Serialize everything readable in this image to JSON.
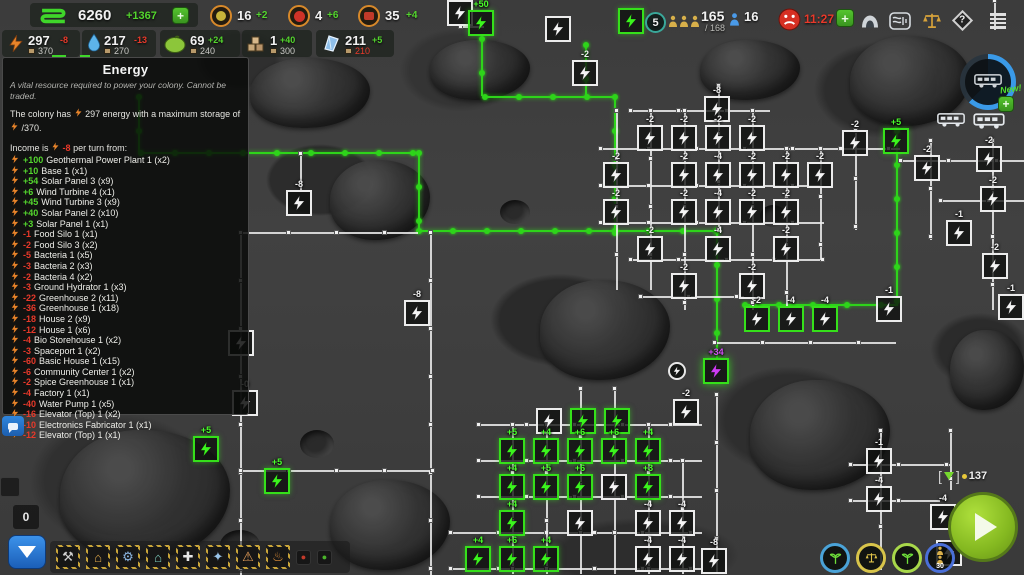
{
  "top_bar": {
    "credits": {
      "value": "6260",
      "delta": "+1367"
    },
    "plus_label": "+",
    "row1": [
      {
        "name": "spice",
        "value": "16",
        "delta": "+2"
      },
      {
        "name": "berries",
        "value": "4",
        "delta": "+6"
      },
      {
        "name": "tools",
        "value": "35",
        "delta": "+4"
      }
    ],
    "resources": [
      {
        "name": "energy",
        "value": "297",
        "delta": "-8",
        "negative": true,
        "cap": "370",
        "cap_red": false
      },
      {
        "name": "water",
        "value": "217",
        "delta": "-13",
        "negative": true,
        "cap": "270",
        "cap_red": false
      },
      {
        "name": "food",
        "value": "69",
        "delta": "+24",
        "negative": false,
        "cap": "240",
        "cap_red": false
      },
      {
        "name": "goods",
        "value": "1",
        "delta": "+40",
        "negative": false,
        "cap": "300",
        "cap_red": false
      },
      {
        "name": "minerals",
        "value": "211",
        "delta": "+5",
        "negative": false,
        "cap": "210",
        "cap_red": true
      }
    ]
  },
  "top_right": {
    "round": "5",
    "population": "165",
    "population_cap": "/ 168",
    "workers": "16",
    "unrest_timer": "11:27",
    "plus_label": "+"
  },
  "rover_panel": {
    "new_label": "New!",
    "plus_label": "+"
  },
  "tooltip": {
    "title": "Energy",
    "description": "A vital resource required to power your colony. Cannot be traded.",
    "line1_pre": "The colony has",
    "line1_mid": "297 energy with a maximum storage of",
    "line1_post": "/370.",
    "income_pre": "Income is",
    "income_value": "-8",
    "income_post": "per turn from:",
    "income_items": [
      {
        "value": "+100",
        "label": "Geothermal Power Plant 1  (x2)"
      },
      {
        "value": "+10",
        "label": "Base 1  (x1)"
      },
      {
        "value": "+54",
        "label": "Solar Panel 3  (x9)"
      },
      {
        "value": "+6",
        "label": "Wind Turbine 4  (x1)"
      },
      {
        "value": "+45",
        "label": "Wind Turbine 3  (x9)"
      },
      {
        "value": "+40",
        "label": "Solar Panel 2  (x10)"
      },
      {
        "value": "+3",
        "label": "Solar Panel 1  (x1)"
      },
      {
        "value": "-1",
        "label": "Food Silo 1  (x1)"
      },
      {
        "value": "-2",
        "label": "Food Silo 3  (x2)"
      },
      {
        "value": "-5",
        "label": "Bacteria 1  (x5)"
      },
      {
        "value": "-3",
        "label": "Bacteria 2  (x3)"
      },
      {
        "value": "-2",
        "label": "Bacteria 4  (x2)"
      },
      {
        "value": "-3",
        "label": "Ground Hydrator 1  (x3)"
      },
      {
        "value": "-22",
        "label": "Greenhouse 2  (x11)"
      },
      {
        "value": "-36",
        "label": "Greenhouse 1  (x18)"
      },
      {
        "value": "-18",
        "label": "House 2  (x9)"
      },
      {
        "value": "-12",
        "label": "House 1  (x6)"
      },
      {
        "value": "-4",
        "label": "Bio Storehouse 1  (x2)"
      },
      {
        "value": "-3",
        "label": "Spaceport 1  (x2)"
      },
      {
        "value": "-60",
        "label": "Basic House 1  (x15)"
      },
      {
        "value": "-6",
        "label": "Community Center 1  (x2)"
      },
      {
        "value": "-2",
        "label": "Spice Greenhouse 1  (x1)"
      },
      {
        "value": "-4",
        "label": "Factory 1  (x1)"
      },
      {
        "value": "-40",
        "label": "Water Pump 1  (x5)"
      },
      {
        "value": "-16",
        "label": "Elevator (Top) 1  (x2)"
      },
      {
        "value": "-10",
        "label": "Electronics Fabricator 1  (x1)"
      },
      {
        "value": "-12",
        "label": "Elevator (Top) 1  (x1)"
      }
    ]
  },
  "bottom": {
    "counter": "0"
  },
  "pod": {
    "value": "137"
  },
  "toolbar": {
    "items": [
      {
        "name": "mining",
        "glyph": "⚒",
        "color": "#cfcfcf",
        "small": false
      },
      {
        "name": "production",
        "glyph": "⌂",
        "color": "#e0a84a",
        "small": false
      },
      {
        "name": "engineering",
        "glyph": "⚙",
        "color": "#8ab4e0",
        "small": false
      },
      {
        "name": "housing",
        "glyph": "⌂",
        "color": "#7fd0c0",
        "small": false
      },
      {
        "name": "storage",
        "glyph": "✚",
        "color": "#e8e8e8",
        "small": false
      },
      {
        "name": "science",
        "glyph": "✦",
        "color": "#9ac4e8",
        "small": false
      },
      {
        "name": "alerts",
        "glyph": "⚠",
        "color": "#e8a05a",
        "small": false
      },
      {
        "name": "heat",
        "glyph": "♨",
        "color": "#e8943a",
        "small": false
      },
      {
        "name": "marker-red",
        "glyph": "●",
        "color": "#c23a2a",
        "small": true
      },
      {
        "name": "marker-green",
        "glyph": "●",
        "color": "#4ab42a",
        "small": true
      }
    ]
  },
  "map": {
    "nodes": [
      {
        "x": 447,
        "y": 0,
        "l": "",
        "t": "c"
      },
      {
        "x": 468,
        "y": 10,
        "l": "+50",
        "t": "p"
      },
      {
        "x": 545,
        "y": 16,
        "l": "",
        "t": "c"
      },
      {
        "x": 572,
        "y": 60,
        "l": "-2",
        "t": "c"
      },
      {
        "x": 618,
        "y": 8,
        "l": "",
        "t": "p"
      },
      {
        "x": 704,
        "y": 96,
        "l": "-8",
        "t": "c"
      },
      {
        "x": 637,
        "y": 125,
        "l": "-2",
        "t": "c"
      },
      {
        "x": 671,
        "y": 125,
        "l": "-2",
        "t": "c"
      },
      {
        "x": 705,
        "y": 125,
        "l": "-2",
        "t": "c"
      },
      {
        "x": 739,
        "y": 125,
        "l": "-2",
        "t": "c"
      },
      {
        "x": 603,
        "y": 162,
        "l": "-2",
        "t": "c"
      },
      {
        "x": 671,
        "y": 162,
        "l": "-2",
        "t": "c"
      },
      {
        "x": 705,
        "y": 162,
        "l": "-4",
        "t": "c"
      },
      {
        "x": 739,
        "y": 162,
        "l": "-2",
        "t": "c"
      },
      {
        "x": 773,
        "y": 162,
        "l": "-2",
        "t": "c"
      },
      {
        "x": 807,
        "y": 162,
        "l": "-2",
        "t": "c"
      },
      {
        "x": 603,
        "y": 199,
        "l": "-2",
        "t": "c"
      },
      {
        "x": 671,
        "y": 199,
        "l": "-2",
        "t": "c"
      },
      {
        "x": 705,
        "y": 199,
        "l": "-4",
        "t": "c"
      },
      {
        "x": 739,
        "y": 199,
        "l": "-2",
        "t": "c"
      },
      {
        "x": 773,
        "y": 199,
        "l": "-2",
        "t": "c"
      },
      {
        "x": 637,
        "y": 236,
        "l": "-2",
        "t": "c"
      },
      {
        "x": 705,
        "y": 236,
        "l": "-4",
        "t": "c"
      },
      {
        "x": 773,
        "y": 236,
        "l": "-2",
        "t": "c"
      },
      {
        "x": 671,
        "y": 273,
        "l": "-2",
        "t": "c"
      },
      {
        "x": 739,
        "y": 273,
        "l": "-2",
        "t": "c"
      },
      {
        "x": 842,
        "y": 130,
        "l": "-2",
        "t": "c"
      },
      {
        "x": 914,
        "y": 155,
        "l": "-2",
        "t": "c"
      },
      {
        "x": 976,
        "y": 146,
        "l": "-2",
        "t": "c"
      },
      {
        "x": 980,
        "y": 186,
        "l": "-2",
        "t": "c"
      },
      {
        "x": 946,
        "y": 220,
        "l": "-1",
        "t": "c"
      },
      {
        "x": 982,
        "y": 253,
        "l": "-2",
        "t": "c"
      },
      {
        "x": 998,
        "y": 294,
        "l": "-1",
        "t": "c"
      },
      {
        "x": 883,
        "y": 128,
        "l": "+5",
        "t": "p"
      },
      {
        "x": 744,
        "y": 306,
        "l": "-2",
        "t": "pw"
      },
      {
        "x": 778,
        "y": 306,
        "l": "-4",
        "t": "pw"
      },
      {
        "x": 812,
        "y": 306,
        "l": "-4",
        "t": "pw"
      },
      {
        "x": 876,
        "y": 296,
        "l": "-1",
        "t": "c"
      },
      {
        "x": 703,
        "y": 358,
        "l": "+34",
        "t": "s"
      },
      {
        "x": 673,
        "y": 399,
        "l": "-2",
        "t": "c"
      },
      {
        "x": 286,
        "y": 190,
        "l": "-8",
        "t": "c"
      },
      {
        "x": 404,
        "y": 300,
        "l": "-8",
        "t": "c"
      },
      {
        "x": 228,
        "y": 330,
        "l": "",
        "t": "c"
      },
      {
        "x": 232,
        "y": 390,
        "l": "-0",
        "t": "c"
      },
      {
        "x": 193,
        "y": 436,
        "l": "+5",
        "t": "p"
      },
      {
        "x": 264,
        "y": 468,
        "l": "+5",
        "t": "p"
      },
      {
        "x": 536,
        "y": 408,
        "l": "",
        "t": "c"
      },
      {
        "x": 570,
        "y": 408,
        "l": "",
        "t": "p"
      },
      {
        "x": 604,
        "y": 408,
        "l": "",
        "t": "p"
      },
      {
        "x": 499,
        "y": 438,
        "l": "+5",
        "t": "p"
      },
      {
        "x": 533,
        "y": 438,
        "l": "+4",
        "t": "p"
      },
      {
        "x": 567,
        "y": 438,
        "l": "+6",
        "t": "p"
      },
      {
        "x": 601,
        "y": 438,
        "l": "+6",
        "t": "p"
      },
      {
        "x": 635,
        "y": 438,
        "l": "+4",
        "t": "p"
      },
      {
        "x": 499,
        "y": 474,
        "l": "+4",
        "t": "p"
      },
      {
        "x": 533,
        "y": 474,
        "l": "+5",
        "t": "p"
      },
      {
        "x": 567,
        "y": 474,
        "l": "+6",
        "t": "p"
      },
      {
        "x": 601,
        "y": 474,
        "l": "",
        "t": "c"
      },
      {
        "x": 635,
        "y": 474,
        "l": "+3",
        "t": "p"
      },
      {
        "x": 499,
        "y": 510,
        "l": "+4",
        "t": "p"
      },
      {
        "x": 567,
        "y": 510,
        "l": "",
        "t": "c"
      },
      {
        "x": 635,
        "y": 510,
        "l": "-4",
        "t": "c"
      },
      {
        "x": 669,
        "y": 510,
        "l": "-4",
        "t": "c"
      },
      {
        "x": 465,
        "y": 546,
        "l": "+4",
        "t": "p"
      },
      {
        "x": 499,
        "y": 546,
        "l": "+6",
        "t": "p"
      },
      {
        "x": 533,
        "y": 546,
        "l": "+4",
        "t": "p"
      },
      {
        "x": 635,
        "y": 546,
        "l": "-4",
        "t": "c"
      },
      {
        "x": 669,
        "y": 546,
        "l": "-4",
        "t": "c"
      },
      {
        "x": 701,
        "y": 548,
        "l": "-8",
        "t": "c"
      },
      {
        "x": 866,
        "y": 448,
        "l": "-1",
        "t": "c"
      },
      {
        "x": 866,
        "y": 486,
        "l": "-4",
        "t": "c"
      },
      {
        "x": 930,
        "y": 504,
        "l": "-4",
        "t": "c"
      },
      {
        "x": 936,
        "y": 540,
        "l": "",
        "t": "c"
      }
    ],
    "lines": [
      {
        "x": 140,
        "y": 152,
        "len": 280,
        "d": "h",
        "c": "g"
      },
      {
        "x": 418,
        "y": 152,
        "len": 80,
        "d": "v",
        "c": "g"
      },
      {
        "x": 418,
        "y": 230,
        "len": 198,
        "d": "h",
        "c": "g"
      },
      {
        "x": 614,
        "y": 96,
        "len": 136,
        "d": "v",
        "c": "g"
      },
      {
        "x": 484,
        "y": 96,
        "len": 130,
        "d": "h",
        "c": "g"
      },
      {
        "x": 481,
        "y": 38,
        "len": 58,
        "d": "v",
        "c": "g"
      },
      {
        "x": 585,
        "y": 44,
        "len": 52,
        "d": "v",
        "c": "g"
      },
      {
        "x": 614,
        "y": 230,
        "len": 102,
        "d": "h",
        "c": "g"
      },
      {
        "x": 716,
        "y": 230,
        "len": 130,
        "d": "v",
        "c": "g"
      },
      {
        "x": 896,
        "y": 130,
        "len": 176,
        "d": "v",
        "c": "g"
      },
      {
        "x": 744,
        "y": 304,
        "len": 152,
        "d": "h",
        "c": "g"
      },
      {
        "x": 138,
        "y": 96,
        "len": 56,
        "d": "v",
        "c": "g"
      },
      {
        "x": 240,
        "y": 232,
        "len": 343,
        "d": "v",
        "c": "w"
      },
      {
        "x": 240,
        "y": 232,
        "len": 178,
        "d": "h",
        "c": "w"
      },
      {
        "x": 300,
        "y": 153,
        "len": 38,
        "d": "v",
        "c": "w"
      },
      {
        "x": 430,
        "y": 232,
        "len": 343,
        "d": "v",
        "c": "w"
      },
      {
        "x": 630,
        "y": 110,
        "len": 140,
        "d": "h",
        "c": "w"
      },
      {
        "x": 600,
        "y": 148,
        "len": 300,
        "d": "h",
        "c": "w"
      },
      {
        "x": 600,
        "y": 185,
        "len": 220,
        "d": "h",
        "c": "w"
      },
      {
        "x": 600,
        "y": 222,
        "len": 224,
        "d": "h",
        "c": "w"
      },
      {
        "x": 630,
        "y": 259,
        "len": 192,
        "d": "h",
        "c": "w"
      },
      {
        "x": 640,
        "y": 296,
        "len": 104,
        "d": "h",
        "c": "w"
      },
      {
        "x": 616,
        "y": 110,
        "len": 180,
        "d": "v",
        "c": "w"
      },
      {
        "x": 650,
        "y": 110,
        "len": 180,
        "d": "v",
        "c": "w"
      },
      {
        "x": 684,
        "y": 110,
        "len": 200,
        "d": "v",
        "c": "w"
      },
      {
        "x": 718,
        "y": 85,
        "len": 145,
        "d": "v",
        "c": "w"
      },
      {
        "x": 752,
        "y": 110,
        "len": 200,
        "d": "v",
        "c": "w"
      },
      {
        "x": 786,
        "y": 148,
        "len": 160,
        "d": "v",
        "c": "w"
      },
      {
        "x": 820,
        "y": 148,
        "len": 112,
        "d": "v",
        "c": "w"
      },
      {
        "x": 855,
        "y": 130,
        "len": 100,
        "d": "v",
        "c": "w"
      },
      {
        "x": 930,
        "y": 140,
        "len": 100,
        "d": "v",
        "c": "w"
      },
      {
        "x": 992,
        "y": 140,
        "len": 170,
        "d": "v",
        "c": "w"
      },
      {
        "x": 900,
        "y": 160,
        "len": 124,
        "d": "h",
        "c": "w"
      },
      {
        "x": 940,
        "y": 200,
        "len": 84,
        "d": "h",
        "c": "w"
      },
      {
        "x": 714,
        "y": 342,
        "len": 182,
        "d": "h",
        "c": "w"
      },
      {
        "x": 716,
        "y": 394,
        "len": 180,
        "d": "v",
        "c": "w"
      },
      {
        "x": 240,
        "y": 470,
        "len": 192,
        "d": "h",
        "c": "w"
      },
      {
        "x": 478,
        "y": 424,
        "len": 224,
        "d": "h",
        "c": "w"
      },
      {
        "x": 478,
        "y": 460,
        "len": 224,
        "d": "h",
        "c": "w"
      },
      {
        "x": 478,
        "y": 496,
        "len": 224,
        "d": "h",
        "c": "w"
      },
      {
        "x": 450,
        "y": 532,
        "len": 252,
        "d": "h",
        "c": "w"
      },
      {
        "x": 450,
        "y": 568,
        "len": 252,
        "d": "h",
        "c": "w"
      },
      {
        "x": 512,
        "y": 424,
        "len": 150,
        "d": "v",
        "c": "w"
      },
      {
        "x": 546,
        "y": 424,
        "len": 150,
        "d": "v",
        "c": "w"
      },
      {
        "x": 580,
        "y": 388,
        "len": 186,
        "d": "v",
        "c": "w"
      },
      {
        "x": 614,
        "y": 388,
        "len": 186,
        "d": "v",
        "c": "w"
      },
      {
        "x": 648,
        "y": 424,
        "len": 150,
        "d": "v",
        "c": "w"
      },
      {
        "x": 682,
        "y": 460,
        "len": 114,
        "d": "v",
        "c": "w"
      },
      {
        "x": 880,
        "y": 430,
        "len": 140,
        "d": "v",
        "c": "w"
      },
      {
        "x": 850,
        "y": 464,
        "len": 100,
        "d": "h",
        "c": "w"
      },
      {
        "x": 850,
        "y": 500,
        "len": 90,
        "d": "h",
        "c": "w"
      },
      {
        "x": 950,
        "y": 430,
        "len": 60,
        "d": "v",
        "c": "w"
      },
      {
        "x": 460,
        "y": 26,
        "len": 24,
        "d": "h",
        "c": "w"
      },
      {
        "x": 994,
        "y": 0,
        "len": 30,
        "d": "v",
        "c": "w"
      }
    ],
    "circle_markers": [
      {
        "x": 668,
        "y": 362
      }
    ],
    "gauges": [
      {
        "x": 820,
        "ring": "#4aa3d8",
        "glyph": "sprout",
        "label": ""
      },
      {
        "x": 856,
        "ring": "#d8c44a",
        "glyph": "scales",
        "label": ""
      },
      {
        "x": 892,
        "ring": "#a8d84a",
        "glyph": "sprout",
        "label": ""
      },
      {
        "x": 925,
        "ring": "#4a6fd8",
        "glyph": "people",
        "label": "30"
      }
    ]
  }
}
